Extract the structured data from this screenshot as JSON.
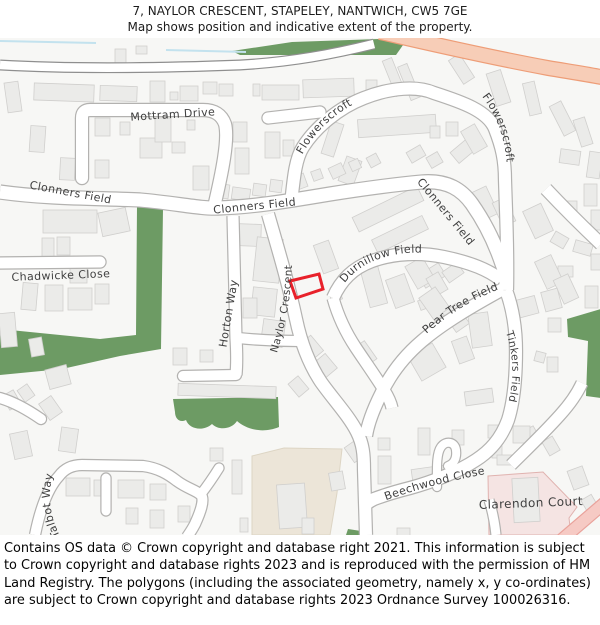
{
  "header": {
    "line1": "7, NAYLOR CRESCENT, STAPELEY, NANTWICH, CW5 7GE",
    "line2": "Map shows position and indicative extent of the property."
  },
  "footer": {
    "text": "Contains OS data © Crown copyright and database right 2021. This information is subject to Crown copyright and database rights 2023 and is reproduced with the permission of HM Land Registry. The polygons (including the associated geometry, namely x, y co-ordinates) are subject to Crown copyright and database rights 2023 Ordnance Survey 100026316."
  },
  "map": {
    "colors": {
      "bg": "#f7f7f5",
      "building_fill": "#ebebe9",
      "building_stroke": "#d0cfcd",
      "road_casing": "#b3b2b0",
      "road_fill": "#ffffff",
      "top_road_casing": "#8f8f8f",
      "green": "#6d9b64",
      "orange_fill": "#f7cdb7",
      "orange_casing": "#ee9d77",
      "pink_road_fill": "#f6cac4",
      "pink_road_casing": "#e9a29b",
      "pink_area_fill": "#f5e4e3",
      "pink_area_stroke": "#e0b2af",
      "beige_fill": "#ece5d8",
      "beige_stroke": "#ddd5c4",
      "stream": "#c3e2ee",
      "label": "#3f3f3f",
      "plot": "#e8212a"
    },
    "areas": [
      {
        "name": "beige-area",
        "d": "M252,418 L284,410 L342,411 L337,455 L330,497 L252,497 Z",
        "fill": "beige_fill",
        "stroke": "beige_stroke"
      },
      {
        "name": "clarendon-pink-area",
        "d": "M488,438 L543,434 L577,469 L569,480 L571,497 L489,497 Z",
        "fill": "pink_area_fill",
        "stroke": "pink_area_stroke"
      }
    ],
    "greens": [
      "M232,13 L292,4 L408,0 L396,17 L240,17 Z",
      "M137,168 L163,171 L161,311 L120,318 L62,331 L0,337 L0,291 L100,301 L136,297 Z",
      "M173,361 L278,359 L279,389 C262,396 246,391 237,383 C232,391 219,393 212,386 C203,394 189,391 186,382 C180,385 175,381 175,374 Z",
      "M567,281 L601,271 L601,360 L586,358 L588,303 L568,299 Z",
      "M346,497 L348,491 L361,493 L361,497 Z"
    ],
    "streams": [
      "M0,3 L96,5",
      "M166,12 L246,14"
    ],
    "buildings": [
      [
        115,
        11,
        11,
        14,
        0
      ],
      [
        136,
        8,
        11,
        8,
        0
      ],
      [
        6,
        44,
        14,
        30,
        -8
      ],
      [
        34,
        46,
        60,
        17,
        2
      ],
      [
        100,
        48,
        37,
        15,
        2
      ],
      [
        150,
        43,
        15,
        21,
        0
      ],
      [
        170,
        54,
        8,
        8,
        0
      ],
      [
        180,
        48,
        18,
        15,
        0
      ],
      [
        203,
        44,
        14,
        12,
        0
      ],
      [
        219,
        46,
        14,
        12,
        0
      ],
      [
        253,
        46,
        7,
        12,
        0
      ],
      [
        262,
        47,
        37,
        15,
        0
      ],
      [
        303,
        41,
        51,
        18,
        -2
      ],
      [
        366,
        42,
        11,
        19,
        0
      ],
      [
        389,
        20,
        10,
        38,
        -22
      ],
      [
        404,
        26,
        10,
        36,
        -22
      ],
      [
        455,
        17,
        13,
        28,
        -33
      ],
      [
        491,
        33,
        15,
        34,
        -18
      ],
      [
        526,
        44,
        12,
        33,
        -13
      ],
      [
        556,
        64,
        13,
        33,
        -27
      ],
      [
        577,
        80,
        12,
        28,
        -18
      ],
      [
        560,
        112,
        20,
        14,
        8
      ],
      [
        588,
        114,
        13,
        26,
        8
      ],
      [
        584,
        146,
        13,
        22,
        0
      ],
      [
        560,
        163,
        17,
        12,
        0
      ],
      [
        591,
        172,
        11,
        20,
        0
      ],
      [
        552,
        196,
        15,
        12,
        30
      ],
      [
        574,
        204,
        18,
        12,
        16
      ],
      [
        591,
        216,
        11,
        16,
        0
      ],
      [
        558,
        228,
        15,
        11,
        0
      ],
      [
        30,
        88,
        15,
        26,
        4
      ],
      [
        60,
        120,
        15,
        22,
        3
      ],
      [
        95,
        80,
        15,
        18,
        0
      ],
      [
        120,
        84,
        10,
        13,
        0
      ],
      [
        140,
        100,
        22,
        20,
        0
      ],
      [
        155,
        80,
        16,
        24,
        0
      ],
      [
        172,
        104,
        13,
        11,
        0
      ],
      [
        187,
        82,
        8,
        10,
        0
      ],
      [
        95,
        122,
        14,
        18,
        0
      ],
      [
        233,
        84,
        14,
        20,
        0
      ],
      [
        235,
        110,
        14,
        26,
        0
      ],
      [
        265,
        94,
        15,
        26,
        0
      ],
      [
        283,
        102,
        11,
        16,
        0
      ],
      [
        358,
        79,
        78,
        18,
        -4
      ],
      [
        430,
        88,
        10,
        12,
        0
      ],
      [
        446,
        84,
        12,
        14,
        0
      ],
      [
        408,
        110,
        16,
        12,
        -30
      ],
      [
        428,
        116,
        13,
        12,
        -30
      ],
      [
        452,
        106,
        22,
        14,
        -40
      ],
      [
        466,
        88,
        16,
        26,
        -30
      ],
      [
        326,
        84,
        13,
        34,
        18
      ],
      [
        342,
        120,
        16,
        26,
        20
      ],
      [
        193,
        128,
        16,
        24,
        0
      ],
      [
        215,
        146,
        14,
        14,
        8
      ],
      [
        232,
        150,
        18,
        12,
        8
      ],
      [
        253,
        146,
        13,
        12,
        8
      ],
      [
        270,
        142,
        12,
        12,
        8
      ],
      [
        292,
        137,
        14,
        14,
        -20
      ],
      [
        312,
        132,
        10,
        10,
        -20
      ],
      [
        330,
        127,
        14,
        12,
        -25
      ],
      [
        350,
        122,
        10,
        10,
        -25
      ],
      [
        368,
        117,
        11,
        11,
        -28
      ],
      [
        43,
        172,
        54,
        23,
        0
      ],
      [
        100,
        172,
        28,
        24,
        -12
      ],
      [
        42,
        200,
        12,
        24,
        0
      ],
      [
        57,
        199,
        13,
        18,
        0
      ],
      [
        22,
        245,
        15,
        27,
        5
      ],
      [
        70,
        225,
        17,
        20,
        0
      ],
      [
        45,
        247,
        18,
        26,
        0
      ],
      [
        68,
        250,
        24,
        22,
        0
      ],
      [
        95,
        246,
        14,
        20,
        0
      ],
      [
        0,
        275,
        16,
        34,
        -5
      ],
      [
        30,
        300,
        13,
        18,
        -10
      ],
      [
        352,
        163,
        72,
        16,
        -26
      ],
      [
        372,
        189,
        56,
        15,
        -26
      ],
      [
        477,
        150,
        16,
        30,
        -25
      ],
      [
        497,
        161,
        14,
        26,
        -25
      ],
      [
        528,
        168,
        20,
        30,
        -25
      ],
      [
        585,
        248,
        13,
        22,
        0
      ],
      [
        365,
        230,
        18,
        38,
        -15
      ],
      [
        390,
        238,
        20,
        30,
        -20
      ],
      [
        420,
        230,
        24,
        15,
        -32
      ],
      [
        444,
        228,
        18,
        13,
        -35
      ],
      [
        419,
        261,
        10,
        10,
        -20
      ],
      [
        235,
        186,
        26,
        22,
        2
      ],
      [
        255,
        200,
        26,
        44,
        6
      ],
      [
        252,
        250,
        24,
        28,
        6
      ],
      [
        262,
        282,
        22,
        26,
        8
      ],
      [
        318,
        204,
        16,
        30,
        -20
      ],
      [
        330,
        252,
        11,
        11,
        -20
      ],
      [
        243,
        260,
        14,
        20,
        0
      ],
      [
        410,
        222,
        20,
        26,
        -30
      ],
      [
        430,
        236,
        14,
        20,
        -30
      ],
      [
        425,
        252,
        20,
        28,
        -35
      ],
      [
        448,
        268,
        16,
        24,
        -35
      ],
      [
        540,
        219,
        18,
        30,
        -25
      ],
      [
        558,
        238,
        16,
        26,
        -25
      ],
      [
        470,
        275,
        20,
        34,
        -8
      ],
      [
        515,
        260,
        22,
        18,
        -15
      ],
      [
        543,
        252,
        17,
        20,
        -15
      ],
      [
        548,
        280,
        13,
        14,
        0
      ],
      [
        455,
        300,
        16,
        24,
        -20
      ],
      [
        535,
        314,
        10,
        10,
        15
      ],
      [
        547,
        319,
        11,
        15,
        0
      ],
      [
        173,
        310,
        14,
        17,
        0
      ],
      [
        200,
        312,
        13,
        12,
        0
      ],
      [
        178,
        347,
        98,
        12,
        2
      ],
      [
        47,
        329,
        22,
        20,
        -15
      ],
      [
        303,
        300,
        16,
        20,
        -40
      ],
      [
        318,
        318,
        15,
        19,
        -40
      ],
      [
        357,
        305,
        15,
        22,
        -35
      ],
      [
        292,
        340,
        13,
        17,
        -40
      ],
      [
        348,
        404,
        15,
        18,
        -35
      ],
      [
        330,
        434,
        14,
        18,
        -10
      ],
      [
        413,
        310,
        28,
        28,
        -30
      ],
      [
        465,
        352,
        28,
        14,
        -8
      ],
      [
        525,
        390,
        14,
        20,
        -30
      ],
      [
        545,
        400,
        12,
        16,
        -30
      ],
      [
        570,
        430,
        16,
        20,
        -20
      ],
      [
        418,
        390,
        12,
        27,
        0
      ],
      [
        452,
        392,
        12,
        15,
        0
      ],
      [
        488,
        387,
        12,
        13,
        0
      ],
      [
        513,
        388,
        17,
        17,
        0
      ],
      [
        492,
        408,
        10,
        12,
        0
      ],
      [
        497,
        417,
        17,
        10,
        0
      ],
      [
        378,
        400,
        12,
        12,
        0
      ],
      [
        378,
        418,
        13,
        28,
        0
      ],
      [
        412,
        429,
        38,
        15,
        -8
      ],
      [
        5,
        354,
        13,
        16,
        -30
      ],
      [
        20,
        348,
        12,
        14,
        -35
      ],
      [
        43,
        360,
        15,
        20,
        -35
      ],
      [
        12,
        394,
        18,
        26,
        -12
      ],
      [
        60,
        390,
        17,
        24,
        8
      ],
      [
        66,
        440,
        24,
        18,
        0
      ],
      [
        94,
        442,
        10,
        16,
        0
      ],
      [
        118,
        442,
        26,
        18,
        0
      ],
      [
        150,
        446,
        16,
        16,
        0
      ],
      [
        126,
        470,
        12,
        16,
        0
      ],
      [
        150,
        472,
        14,
        18,
        0
      ],
      [
        178,
        468,
        12,
        16,
        0
      ],
      [
        210,
        410,
        13,
        13,
        0
      ],
      [
        232,
        422,
        10,
        34,
        0
      ],
      [
        240,
        480,
        8,
        14,
        0
      ],
      [
        278,
        446,
        28,
        44,
        -4
      ],
      [
        302,
        480,
        12,
        16,
        0
      ],
      [
        513,
        440,
        26,
        44,
        -3
      ],
      [
        585,
        458,
        12,
        20,
        -30
      ],
      [
        397,
        490,
        13,
        8,
        0
      ]
    ],
    "roads": [
      {
        "name": "boundary-road",
        "d": "M0,27 C70,31 160,30 240,27 C292,24 334,16 374,6",
        "w": 8.5,
        "casing": "top_road_casing"
      },
      {
        "name": "clonners-field-road",
        "d": "M0,154 C50,161 100,160 140,162 C175,165 202,171 218,170 C252,169 282,164 330,156 C368,150 400,146 422,144 C448,142 462,152 472,166 C486,186 496,208 502,226 C506,236 506,242 506,250",
        "w": 13
      },
      {
        "name": "mottram-drive-road",
        "d": "M82,140 L82,80 Q82,72 90,72 L203,72 Q220,72 225,86 C229,101 222,135 214,169",
        "w": 12,
        "cap": "round"
      },
      {
        "name": "flowerscroft-road",
        "d": "M291,166 C294,136 296,120 303,109 C315,90 338,70 364,60 C392,49 418,48 434,55 C462,64 488,73 495,91 C502,109 505,122 505,142 C506,175 508,212 507,252",
        "w": 12
      },
      {
        "name": "flowerscroft-stub",
        "d": "M268,80 L320,74",
        "w": 11,
        "cap": "round"
      },
      {
        "name": "naylor-crescent-road",
        "d": "M268,176 C279,214 289,248 296,281 C301,305 309,326 321,344 C333,361 349,378 357,394 C363,406 364,416 364,432 L366,497",
        "w": 12
      },
      {
        "name": "durnillow-field-road",
        "d": "M333,260 C341,242 353,230 372,223 C394,215 420,214 444,219 C468,224 488,231 501,242",
        "w": 12
      },
      {
        "name": "durnillow-south-road",
        "d": "M333,260 C338,278 346,295 356,310 C366,325 376,339 384,352 C389,360 391,365 392,370",
        "w": 11
      },
      {
        "name": "pear-tree-field-road",
        "d": "M503,251 C472,268 443,285 422,303 C402,320 389,339 381,356 C373,372 368,385 366,398",
        "w": 12
      },
      {
        "name": "tinkers-beechwood-road",
        "d": "M506,252 C513,271 516,293 516,313 C516,341 514,363 508,382 C501,401 490,413 476,422 C458,434 432,444 410,450 C394,454 382,458 374,461 C370,463 367,465 366,467",
        "w": 12
      },
      {
        "name": "beechwood-hook",
        "d": "M437,449 C437,432 436,416 441,409 C446,402 455,404 456,412 C457,420 454,426 448,428",
        "w": 8,
        "cap": "round"
      },
      {
        "name": "horton-way-road",
        "d": "M233,178 L236,300 C237,316 237,326 236,337",
        "w": 11
      },
      {
        "name": "horton-stub",
        "d": "M183,338 L236,337",
        "w": 10,
        "cap": "round"
      },
      {
        "name": "horton-east-link",
        "d": "M238,300 C258,302 282,303 299,303",
        "w": 10
      },
      {
        "name": "chadwicke-close-road",
        "d": "M0,225 L100,224",
        "w": 11,
        "cap": "round"
      },
      {
        "name": "talbot-way-road",
        "d": "M35,497 C39,477 46,452 59,438 C65,430 73,427 82,427 L143,428 C158,430 168,436 177,443 C188,451 196,452 201,457 C205,462 200,475 195,486 C192,492 189,496 187,499",
        "w": 10
      },
      {
        "name": "talbot-stub-1",
        "d": "M106,440 L106,473",
        "w": 9,
        "cap": "round"
      },
      {
        "name": "talbot-stub-2",
        "d": "M201,456 C208,447 214,438 219,430",
        "w": 9,
        "cap": "round"
      },
      {
        "name": "nw-curve-road",
        "d": "M0,360 C14,364 28,372 41,381",
        "w": 10,
        "cap": "round"
      },
      {
        "name": "east-road-1",
        "d": "M546,151 C562,168 582,188 601,206",
        "w": 12
      },
      {
        "name": "east-road-2",
        "d": "M511,427 C525,413 543,396 560,377 C570,366 577,356 582,345",
        "w": 11
      },
      {
        "name": "clarendon-west-road",
        "d": "M489,462 C493,475 495,487 496,497",
        "w": 9
      },
      {
        "name": "main-orange-road",
        "d": "M380,-6 C440,8 505,22 548,30 C572,34 592,37 606,40",
        "w": 13.5,
        "fill": "orange_fill",
        "casing": "orange_casing"
      },
      {
        "name": "pink-road",
        "d": "M552,510 L608,462",
        "w": 11,
        "fill": "pink_road_fill",
        "casing": "pink_road_casing"
      }
    ],
    "plot": {
      "points": "290,243 319,236 323,251 296,260"
    },
    "labels": [
      {
        "text": "Mottram Drive",
        "size": 11,
        "path": "M126,83 L220,77"
      },
      {
        "text": "Clonners Field",
        "size": 11,
        "path": "M6,146 L134,170"
      },
      {
        "text": "Chadwicke Close",
        "size": 11,
        "path": "M8,243 L114,239"
      },
      {
        "text": "Clonners Field",
        "size": 11,
        "path": "M200,177 L310,166"
      },
      {
        "text": "Flowerscroft",
        "size": 11,
        "path": "M296,130 C308,100 330,76 366,60"
      },
      {
        "text": "Flowerscroft",
        "size": 11,
        "path": "M480,56 C496,76 505,98 507,128"
      },
      {
        "text": "Clonners Field",
        "size": 11,
        "path": "M410,136 L476,216"
      },
      {
        "text": "Durnillow Field",
        "size": 11,
        "path": "M334,262 C346,238 362,226 382,220 C400,214 420,213 442,217"
      },
      {
        "text": "Horton Way",
        "size": 11,
        "path": "M226,312 L238,240"
      },
      {
        "text": "Naylor Crescent",
        "size": 10.5,
        "path": "M276,318 C285,290 291,262 292,224"
      },
      {
        "text": "Pear Tree Field",
        "size": 11,
        "path": "M424,298 C446,278 470,262 502,250"
      },
      {
        "text": "Tinkers Field",
        "size": 10.5,
        "path": "M505,292 C513,314 515,338 508,366"
      },
      {
        "text": "Beechwood Close",
        "size": 11,
        "path": "M376,466 C412,452 452,442 496,434"
      },
      {
        "text": "Clarendon Court",
        "size": 12,
        "path": "M478,471 L584,467"
      },
      {
        "text": "Talbot Way",
        "size": 11,
        "path": "M60,498 C50,478 47,458 53,436"
      }
    ]
  }
}
